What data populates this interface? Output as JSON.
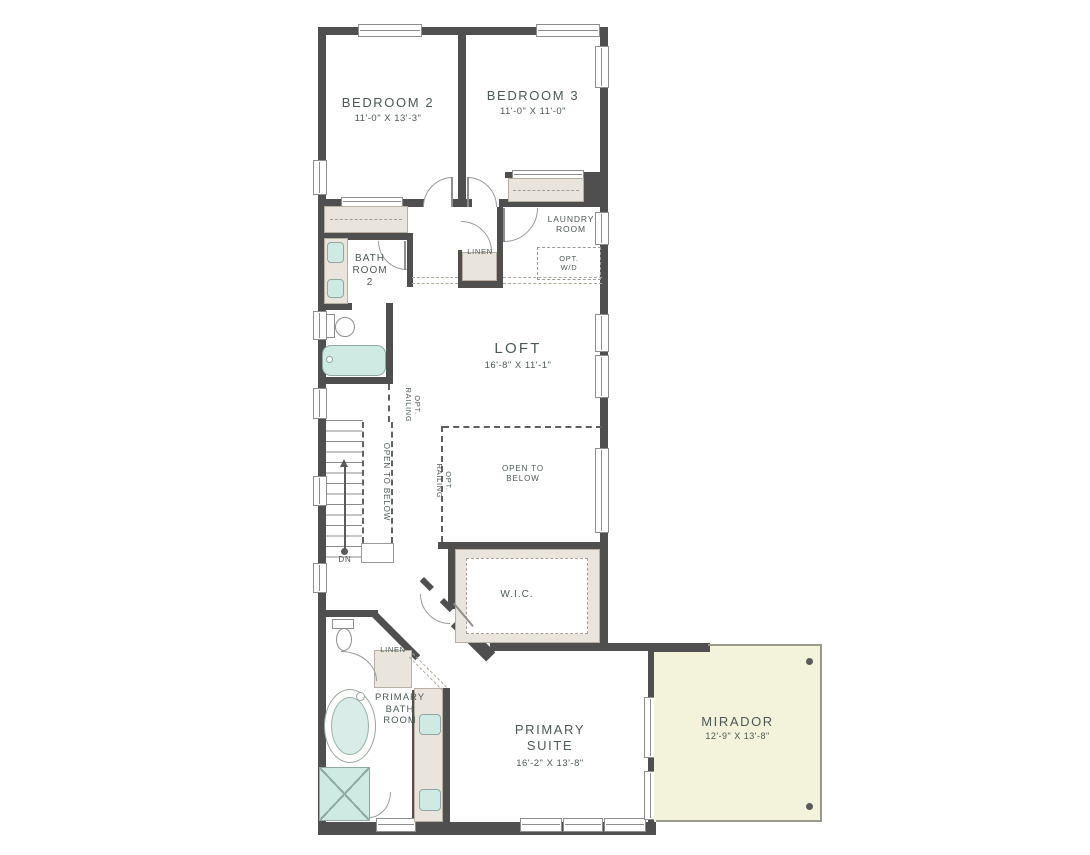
{
  "rooms": {
    "bedroom2": {
      "name": "BEDROOM 2",
      "dims": "11'-0\" x 13'-3\""
    },
    "bedroom3": {
      "name": "BEDROOM 3",
      "dims": "11'-0\" x 11'-0\""
    },
    "laundry": {
      "name": "LAUNDRY ROOM"
    },
    "bath2": {
      "name": "BATH ROOM 2"
    },
    "loft": {
      "name": "LOFT",
      "dims": "16'-8\" x 11'-1\""
    },
    "open_to_below": {
      "name": "OPEN TO BELOW"
    },
    "wic": {
      "name": "W.I.C."
    },
    "primary_bath": {
      "name": "PRIMARY BATH ROOM"
    },
    "primary_suite": {
      "name": "PRIMARY SUITE",
      "dims": "16'-2\" x 13'-8\""
    },
    "mirador": {
      "name": "MIRADOR",
      "dims": "12'-9\" x 13'-8\""
    }
  },
  "annotations": {
    "linen": "LINEN",
    "opt_wd": "OPT. W/D",
    "opt_railing": "OPT. RAILING",
    "open_to_below_rail": "OPEN TO BELOW",
    "down": "DN"
  },
  "colors": {
    "wall": "#4f4f4f",
    "casework_fill": "#e9e5dc",
    "plumbing_fixture_fill": "#cfe9e3",
    "deck_fill": "#f2f3da",
    "label_text": "#4d5956"
  }
}
